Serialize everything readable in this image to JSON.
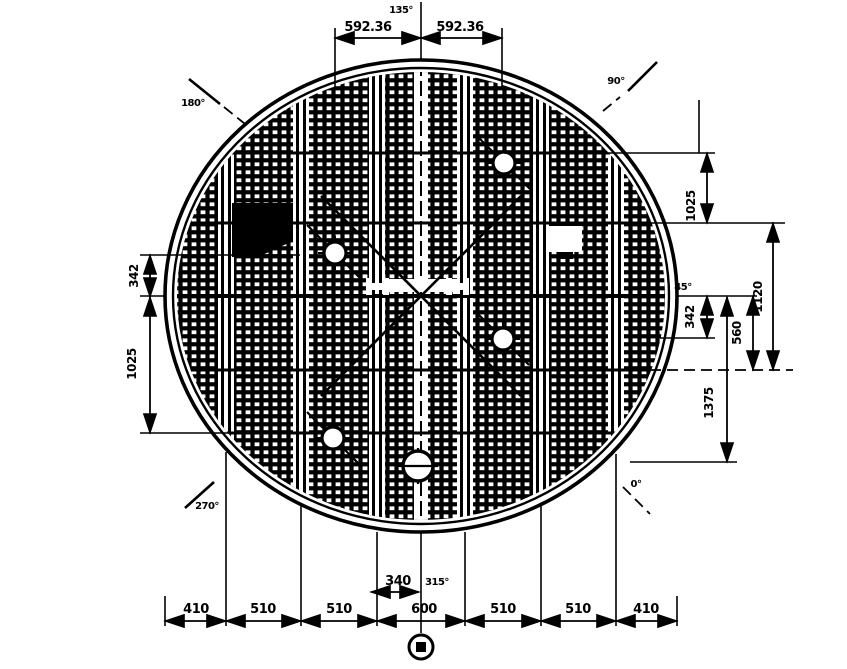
{
  "drawing": {
    "type": "circular-grating-plan",
    "ink": "#000000",
    "background": "#ffffff",
    "dims": {
      "top": [
        "592.36",
        "592.36"
      ],
      "right": {
        "d1025": "1025",
        "d1120": "1120",
        "d560": "560",
        "d342": "342",
        "d1375": "1375"
      },
      "left": {
        "d342": "342",
        "d1025": "1025"
      },
      "bottom": [
        "410",
        "510",
        "510",
        "600",
        "510",
        "510",
        "410"
      ],
      "center_340": "340"
    },
    "angles": {
      "top": "135°",
      "top_left": "180°",
      "top_right": "90°",
      "right": "45°",
      "bottom_right": "0°",
      "bottom": "315°",
      "bottom_left": "270°"
    }
  }
}
